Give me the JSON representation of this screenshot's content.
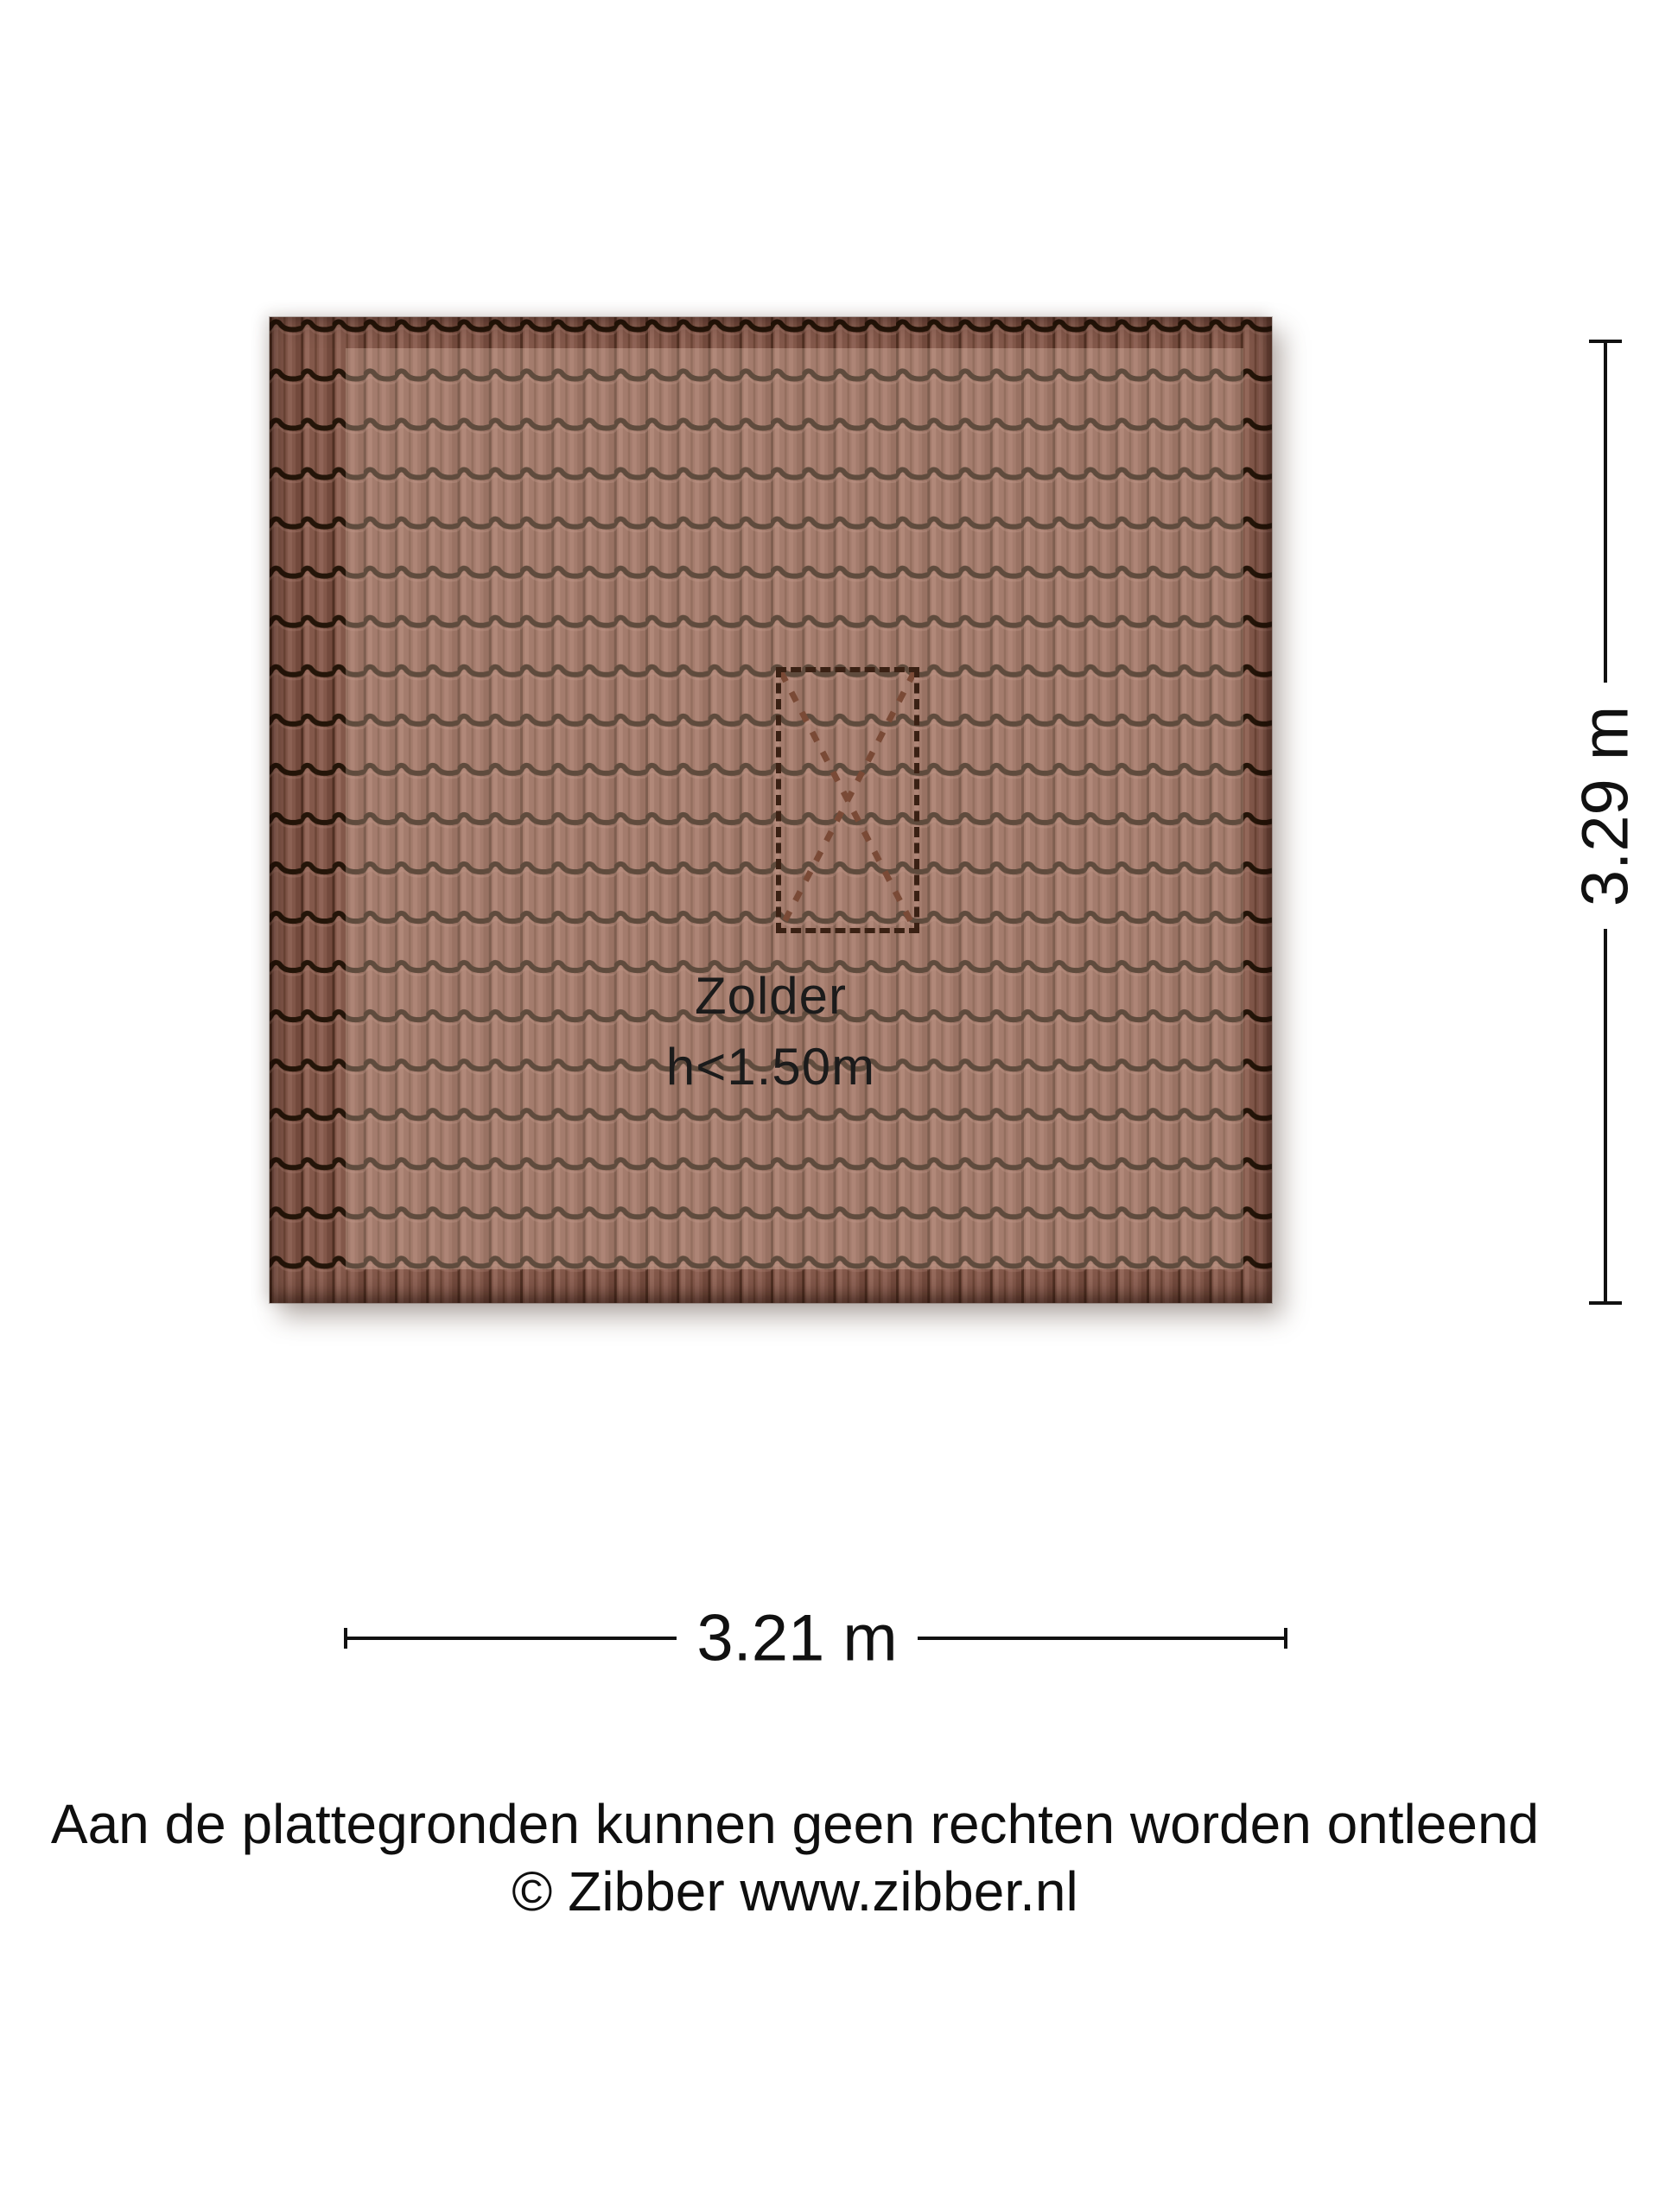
{
  "floorplan": {
    "room": {
      "name": "Zolder",
      "height_note": "h<1.50m"
    },
    "dimensions": {
      "width": "3.21 m",
      "height": "3.29 m"
    },
    "icons": {
      "roof_window": "dashed rectangle with X cross (roof window / dakraam)"
    },
    "colors": {
      "tile_base": "#83584a",
      "tile_wave": "#241509",
      "tile_ridge_light": "#b08275",
      "tile_groove": "#47291c",
      "highlight_overlay": "rgba(255,222,202,0.27)",
      "window_border": "#3a2114",
      "window_diagonal": "#7a4a36",
      "dimension_line": "#111111",
      "text": "#141414",
      "background": "#ffffff"
    }
  },
  "footer": {
    "disclaimer": "Aan de plattegronden kunnen geen rechten worden ontleend",
    "copyright": "© Zibber www.zibber.nl"
  }
}
